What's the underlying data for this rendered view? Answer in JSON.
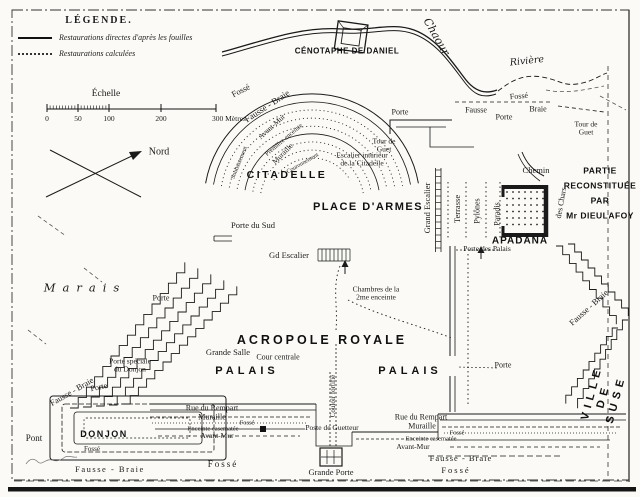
{
  "map": {
    "colors": {
      "ink": "#1a1a1a",
      "paper": "#fbfaf6"
    },
    "legend": {
      "heading": "LÉGENDE.",
      "items": [
        {
          "style": "solid",
          "label": "Restaurations directes d'après les fouilles"
        },
        {
          "style": "dotted",
          "label": "Restaurations calculées"
        }
      ]
    },
    "scale": {
      "heading": "Échelle",
      "ticks": [
        {
          "t": "0",
          "x": 47
        },
        {
          "t": "50",
          "x": 78
        },
        {
          "t": "100",
          "x": 109
        },
        {
          "t": "200",
          "x": 161
        },
        {
          "t": "300 Mètres.",
          "x": 216,
          "a": "l"
        }
      ]
    },
    "labels": [
      {
        "id": "cenotaphe-de-daniel",
        "text": "CÉNOTAPHE DE DANIEL",
        "x": 347,
        "y": 52,
        "fs": 8,
        "ls": 0.5,
        "cls": "caps"
      },
      {
        "id": "chaour",
        "text": "Chaour",
        "x": 436,
        "y": 37,
        "rot": 60,
        "fs": 11,
        "cls": "ital"
      },
      {
        "id": "riviere",
        "text": "Rivière",
        "x": 527,
        "y": 62,
        "rot": -6,
        "fs": 9.5,
        "cls": "ital"
      },
      {
        "id": "fosse-nord",
        "text": "Fossé",
        "x": 519,
        "y": 97,
        "rot": -5,
        "fs": 8
      },
      {
        "id": "fausse-nord",
        "text": "Fausse",
        "x": 476,
        "y": 111,
        "fs": 8
      },
      {
        "id": "braie-nord",
        "text": "Braie",
        "x": 538,
        "y": 110,
        "fs": 8
      },
      {
        "id": "porte-nord-est",
        "text": "Porte",
        "x": 504,
        "y": 118,
        "fs": 8
      },
      {
        "id": "tour-de-guet-ne",
        "text": "Tour de\nGuet",
        "x": 586,
        "y": 129,
        "fs": 7.5
      },
      {
        "id": "porte-nord",
        "text": "Porte",
        "x": 400,
        "y": 113,
        "fs": 8
      },
      {
        "id": "ring-fosse",
        "text": "Fossé",
        "x": 241,
        "y": 91,
        "rot": -27,
        "fs": 8.5
      },
      {
        "id": "ring-fausse-braie",
        "text": "Fausse - Braie",
        "x": 267,
        "y": 106,
        "rot": -33,
        "fs": 9
      },
      {
        "id": "ring-avant-mur",
        "text": "Avant-Mur",
        "x": 272,
        "y": 127,
        "rot": -42,
        "fs": 7.5
      },
      {
        "id": "ring-premiere-enceinte",
        "text": "Première enceinte",
        "x": 284,
        "y": 140,
        "rot": -40,
        "fs": 6.5
      },
      {
        "id": "ring-muraille",
        "text": "Muraille",
        "x": 283,
        "y": 154,
        "rot": -45,
        "fs": 7.5
      },
      {
        "id": "ring-couronnement",
        "text": "Couronnement",
        "x": 303,
        "y": 164,
        "rot": -30,
        "fs": 6
      },
      {
        "id": "ring-soubassement",
        "text": "Soubassement",
        "x": 240,
        "y": 163,
        "rot": -68,
        "fs": 6
      },
      {
        "id": "tour-de-guet-citadelle",
        "text": "Tour de\nGuet",
        "x": 384,
        "y": 146,
        "fs": 7.5
      },
      {
        "id": "escalier-interieur",
        "text": "Escalier intérieur\nde la Citadelle",
        "x": 362,
        "y": 160,
        "fs": 7.5
      },
      {
        "id": "citadelle",
        "text": "CITADELLE",
        "x": 287,
        "y": 176,
        "fs": 10.5,
        "ls": 2.5,
        "cls": "caps"
      },
      {
        "id": "place-darmes",
        "text": "PLACE D'ARMES",
        "x": 368,
        "y": 207,
        "fs": 11,
        "ls": 1.5,
        "cls": "caps"
      },
      {
        "id": "porte-du-sud",
        "text": "Porte du Sud",
        "x": 253,
        "y": 226,
        "fs": 8.5
      },
      {
        "id": "grand-escalier-v",
        "text": "Grand Escalier",
        "x": 428,
        "y": 208,
        "rot": -90,
        "fs": 8.5
      },
      {
        "id": "terrasse",
        "text": "Terrasse",
        "x": 458,
        "y": 209,
        "rot": -90,
        "fs": 8.5
      },
      {
        "id": "pylones",
        "text": "Pylônes",
        "x": 478,
        "y": 211,
        "rot": -90,
        "fs": 8
      },
      {
        "id": "paradis",
        "text": "Paradis",
        "x": 498,
        "y": 214,
        "rot": -90,
        "fs": 8
      },
      {
        "id": "chemin",
        "text": "Chemin",
        "x": 536,
        "y": 171,
        "fs": 8.5
      },
      {
        "id": "des-chars",
        "text": "des Chars",
        "x": 562,
        "y": 203,
        "rot": -80,
        "fs": 8
      },
      {
        "id": "partie-reconstituee",
        "text": "PARTIE\nRECONSTITUÉE\nPAR\nMr DIEULAFOY",
        "x": 600,
        "y": 193,
        "fs": 8.5,
        "ls": 0.5,
        "lh": 1.75,
        "cls": "caps"
      },
      {
        "id": "apadana",
        "text": "APADÂNA",
        "x": 520,
        "y": 241,
        "fs": 10,
        "ls": 1,
        "cls": "caps"
      },
      {
        "id": "porte-des-palais",
        "text": "Porte des Palais",
        "x": 487,
        "y": 249,
        "fs": 7.5
      },
      {
        "id": "fausse-braie-est",
        "text": "Fausse - Braie",
        "x": 589,
        "y": 308,
        "rot": -42,
        "fs": 8.5
      },
      {
        "id": "gd-escalier",
        "text": "Gd Escalier",
        "x": 289,
        "y": 256,
        "fs": 8.5
      },
      {
        "id": "chambres",
        "text": "Chambres de la\n2me enceinte",
        "x": 376,
        "y": 294,
        "fs": 7.5
      },
      {
        "id": "acropole-royale",
        "text": "ACROPOLE ROYALE",
        "x": 322,
        "y": 340,
        "fs": 12.5,
        "ls": 3,
        "cls": "caps"
      },
      {
        "id": "grande-salle",
        "text": "Grande Salle",
        "x": 228,
        "y": 353,
        "fs": 8.5
      },
      {
        "id": "cour-centrale",
        "text": "Cour centrale",
        "x": 278,
        "y": 358,
        "fs": 8
      },
      {
        "id": "palais-ouest",
        "text": "PALAIS",
        "x": 247,
        "y": 371,
        "fs": 11,
        "ls": 4,
        "cls": "caps"
      },
      {
        "id": "palais-est",
        "text": "PALAIS",
        "x": 410,
        "y": 371,
        "fs": 11,
        "ls": 4,
        "cls": "caps"
      },
      {
        "id": "marais",
        "text": "Marais",
        "x": 85,
        "y": 288,
        "fs": 11.5,
        "ls": 7,
        "cls": "ital"
      },
      {
        "id": "porte-ouest",
        "text": "Porte",
        "x": 161,
        "y": 299,
        "fs": 8
      },
      {
        "id": "porte-speciale-donjon",
        "text": "Porte spéciale\ndu Donjon",
        "x": 130,
        "y": 366,
        "fs": 7.5
      },
      {
        "id": "fausse-braie-ouest",
        "text": "Fausse - Braie",
        "x": 72,
        "y": 392,
        "rot": -30,
        "fs": 8.5
      },
      {
        "id": "porte-sud-ouest",
        "text": "Porte",
        "x": 99,
        "y": 388,
        "rot": -12,
        "fs": 8
      },
      {
        "id": "pont",
        "text": "Pont",
        "x": 34,
        "y": 438,
        "fs": 9
      },
      {
        "id": "donjon",
        "text": "DONJON",
        "x": 104,
        "y": 434,
        "fs": 9,
        "ls": 1.5,
        "cls": "caps"
      },
      {
        "id": "fosse-donjon",
        "text": "Fossé",
        "x": 92,
        "y": 450,
        "fs": 7
      },
      {
        "id": "fausse-braie-sud",
        "text": "Fausse - Braie",
        "x": 110,
        "y": 470,
        "fs": 8.5,
        "ls": 1.5
      },
      {
        "id": "rue-du-rempart-ouest",
        "text": "Rue du Rempart",
        "x": 212,
        "y": 409,
        "fs": 8
      },
      {
        "id": "muraille-ouest",
        "text": "Muraille",
        "x": 212,
        "y": 418,
        "fs": 8
      },
      {
        "id": "fosse-petit-ouest",
        "text": "Fossé",
        "x": 247,
        "y": 423,
        "fs": 6.5
      },
      {
        "id": "enceinte-casematee-ouest",
        "text": "Enceinte casematée",
        "x": 213,
        "y": 429,
        "fs": 6.5
      },
      {
        "id": "avant-mur-ouest",
        "text": "Avant-Mur",
        "x": 217,
        "y": 436,
        "fs": 7.5
      },
      {
        "id": "fosse-sud-ouest",
        "text": "Fossé",
        "x": 223,
        "y": 464,
        "fs": 9,
        "ls": 2
      },
      {
        "id": "couloir-fortifie",
        "text": "Couloir fortifié",
        "x": 334,
        "y": 396,
        "rot": -90,
        "fs": 7
      },
      {
        "id": "poste-de-guetteur",
        "text": "Poste de Guetteur",
        "x": 332,
        "y": 428,
        "fs": 7.5
      },
      {
        "id": "grande-porte",
        "text": "Grande Porte",
        "x": 331,
        "y": 473,
        "fs": 8.5
      },
      {
        "id": "rue-du-rempart-est",
        "text": "Rue du Rempart",
        "x": 421,
        "y": 418,
        "fs": 8
      },
      {
        "id": "muraille-est",
        "text": "Muraille",
        "x": 422,
        "y": 427,
        "fs": 8
      },
      {
        "id": "fosse-petit-est",
        "text": "Fossé",
        "x": 457,
        "y": 433,
        "fs": 6.5
      },
      {
        "id": "enceinte-casematee-est",
        "text": "Enceinte casematée",
        "x": 431,
        "y": 439,
        "fs": 6.5
      },
      {
        "id": "avant-mur-est",
        "text": "Avant-Mur",
        "x": 413,
        "y": 447,
        "fs": 7.5
      },
      {
        "id": "fausse-braie-sud-est",
        "text": "Fausse - Braie",
        "x": 461,
        "y": 459,
        "fs": 8.5,
        "ls": 1
      },
      {
        "id": "fosse-sud-est",
        "text": "Fossé",
        "x": 456,
        "y": 471,
        "fs": 8.5,
        "ls": 2
      },
      {
        "id": "porte-est",
        "text": "Porte",
        "x": 503,
        "y": 366,
        "fs": 8
      },
      {
        "id": "ville-de-suse",
        "text": "VILLE DE SUSE",
        "x": 604,
        "y": 396,
        "rot": -75,
        "fs": 11,
        "ls": 5,
        "cls": "caps"
      },
      {
        "id": "nord",
        "text": "Nord",
        "x": 159,
        "y": 152,
        "fs": 10
      }
    ]
  }
}
